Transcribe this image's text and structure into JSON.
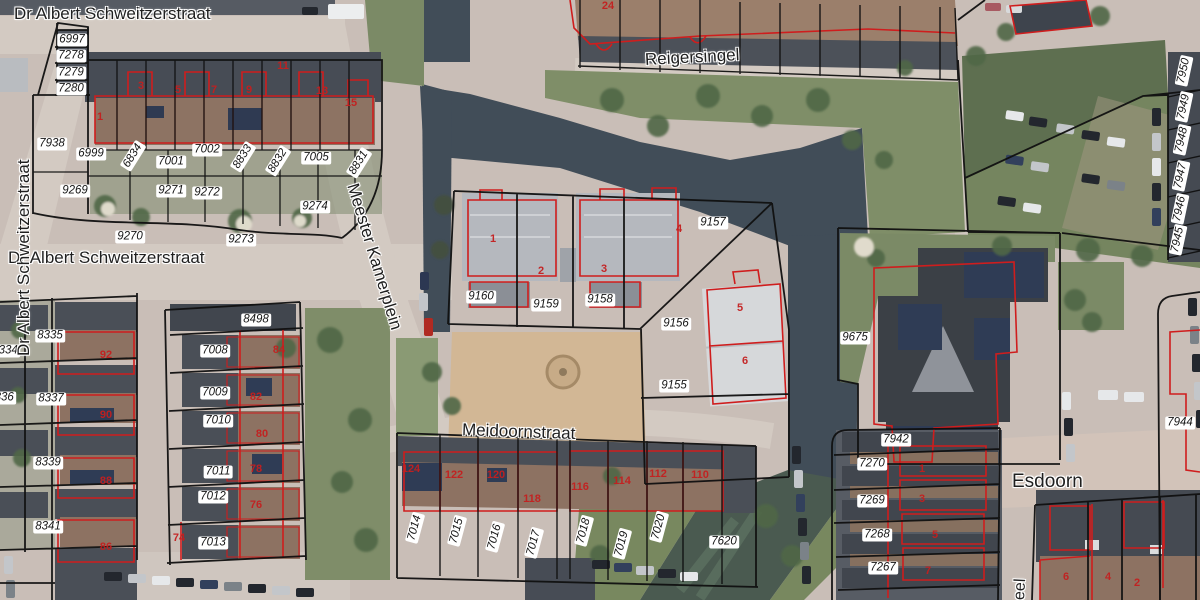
{
  "colors": {
    "parcel_line": "#101010",
    "building_outline": "#cf1d1d",
    "label_bg": "#ffffff",
    "label_text": "#141414",
    "house_number": "#c41f1f",
    "street_text": "#1f1f1f"
  },
  "streets": [
    {
      "name": "Dr Albert Schweitzerstraat",
      "x": 14,
      "y": 14,
      "rot": 0,
      "size": 17
    },
    {
      "name": "Dr Albert Schweitzerstraat",
      "x": 8,
      "y": 258,
      "rot": 0,
      "size": 17
    },
    {
      "name": "Dr Albert Schweitzerstraat",
      "x": 24,
      "y": 356,
      "rot": -90,
      "size": 17
    },
    {
      "name": "Reigersingel",
      "x": 645,
      "y": 60,
      "rot": -3,
      "size": 17
    },
    {
      "name": "Meester Kamerplein",
      "x": 352,
      "y": 184,
      "rot": 73,
      "size": 17
    },
    {
      "name": "Meidoornstraat",
      "x": 462,
      "y": 430,
      "rot": 2,
      "size": 17
    },
    {
      "name": "Esdoorn",
      "x": 1012,
      "y": 482,
      "rot": 0,
      "size": 19
    },
    {
      "name": "eel",
      "x": 1020,
      "y": 600,
      "rot": -87,
      "size": 16
    }
  ],
  "parcel_labels": [
    {
      "id": "6997",
      "x": 72,
      "y": 40
    },
    {
      "id": "7278",
      "x": 71,
      "y": 56
    },
    {
      "id": "7279",
      "x": 71,
      "y": 73
    },
    {
      "id": "7280",
      "x": 71,
      "y": 89
    },
    {
      "id": "7938",
      "x": 52,
      "y": 144
    },
    {
      "id": "6999",
      "x": 91,
      "y": 154
    },
    {
      "id": "6834",
      "x": 133,
      "y": 156,
      "rot": -58
    },
    {
      "id": "7001",
      "x": 171,
      "y": 162
    },
    {
      "id": "7002",
      "x": 207,
      "y": 150
    },
    {
      "id": "8833",
      "x": 243,
      "y": 157,
      "rot": -58
    },
    {
      "id": "8832",
      "x": 278,
      "y": 161,
      "rot": -58
    },
    {
      "id": "7005",
      "x": 316,
      "y": 158
    },
    {
      "id": "8831",
      "x": 359,
      "y": 163,
      "rot": -58
    },
    {
      "id": "9269",
      "x": 75,
      "y": 191
    },
    {
      "id": "9271",
      "x": 171,
      "y": 191
    },
    {
      "id": "9272",
      "x": 207,
      "y": 193
    },
    {
      "id": "9274",
      "x": 315,
      "y": 207
    },
    {
      "id": "9270",
      "x": 130,
      "y": 237
    },
    {
      "id": "9273",
      "x": 241,
      "y": 240
    },
    {
      "id": "8334",
      "x": 5,
      "y": 351
    },
    {
      "id": "8335",
      "x": 50,
      "y": 336
    },
    {
      "id": "8336",
      "x": 1,
      "y": 398
    },
    {
      "id": "8337",
      "x": 51,
      "y": 399
    },
    {
      "id": "8339",
      "x": 48,
      "y": 463
    },
    {
      "id": "8341",
      "x": 48,
      "y": 527
    },
    {
      "id": "8498",
      "x": 256,
      "y": 320
    },
    {
      "id": "7008",
      "x": 215,
      "y": 351
    },
    {
      "id": "7009",
      "x": 215,
      "y": 393
    },
    {
      "id": "7010",
      "x": 218,
      "y": 421
    },
    {
      "id": "7011",
      "x": 218,
      "y": 472
    },
    {
      "id": "7012",
      "x": 213,
      "y": 497
    },
    {
      "id": "7013",
      "x": 213,
      "y": 543
    },
    {
      "id": "9160",
      "x": 481,
      "y": 297
    },
    {
      "id": "9159",
      "x": 546,
      "y": 305
    },
    {
      "id": "9158",
      "x": 600,
      "y": 300
    },
    {
      "id": "9157",
      "x": 713,
      "y": 223
    },
    {
      "id": "9156",
      "x": 676,
      "y": 324
    },
    {
      "id": "9155",
      "x": 674,
      "y": 386
    },
    {
      "id": "9675",
      "x": 855,
      "y": 338
    },
    {
      "id": "7942",
      "x": 896,
      "y": 440
    },
    {
      "id": "7270",
      "x": 872,
      "y": 464
    },
    {
      "id": "7269",
      "x": 872,
      "y": 501
    },
    {
      "id": "7268",
      "x": 877,
      "y": 535
    },
    {
      "id": "7267",
      "x": 883,
      "y": 568
    },
    {
      "id": "7620",
      "x": 724,
      "y": 542
    },
    {
      "id": "7014",
      "x": 415,
      "y": 528,
      "rot": -75
    },
    {
      "id": "7015",
      "x": 457,
      "y": 531,
      "rot": -75
    },
    {
      "id": "7016",
      "x": 495,
      "y": 537,
      "rot": -75
    },
    {
      "id": "7017",
      "x": 534,
      "y": 543,
      "rot": -75
    },
    {
      "id": "7018",
      "x": 584,
      "y": 531,
      "rot": -75
    },
    {
      "id": "7019",
      "x": 622,
      "y": 544,
      "rot": -75
    },
    {
      "id": "7020",
      "x": 659,
      "y": 527,
      "rot": -75
    },
    {
      "id": "7950",
      "x": 1184,
      "y": 71,
      "rot": -78
    },
    {
      "id": "7949",
      "x": 1184,
      "y": 107,
      "rot": -78
    },
    {
      "id": "7948",
      "x": 1182,
      "y": 140,
      "rot": -78
    },
    {
      "id": "7947",
      "x": 1181,
      "y": 176,
      "rot": -78
    },
    {
      "id": "7946",
      "x": 1180,
      "y": 209,
      "rot": -78
    },
    {
      "id": "7945",
      "x": 1178,
      "y": 240,
      "rot": -78
    },
    {
      "id": "7944",
      "x": 1180,
      "y": 423
    }
  ],
  "house_numbers": [
    {
      "n": "1",
      "x": 100,
      "y": 117
    },
    {
      "n": "3",
      "x": 141,
      "y": 86
    },
    {
      "n": "5",
      "x": 178,
      "y": 90
    },
    {
      "n": "7",
      "x": 214,
      "y": 90
    },
    {
      "n": "9",
      "x": 249,
      "y": 90
    },
    {
      "n": "11",
      "x": 283,
      "y": 66
    },
    {
      "n": "13",
      "x": 322,
      "y": 91
    },
    {
      "n": "15",
      "x": 351,
      "y": 103
    },
    {
      "n": "24",
      "x": 608,
      "y": 6
    },
    {
      "n": "92",
      "x": 106,
      "y": 355
    },
    {
      "n": "90",
      "x": 106,
      "y": 415
    },
    {
      "n": "88",
      "x": 106,
      "y": 481
    },
    {
      "n": "86",
      "x": 106,
      "y": 547
    },
    {
      "n": "84",
      "x": 279,
      "y": 350
    },
    {
      "n": "82",
      "x": 256,
      "y": 397
    },
    {
      "n": "80",
      "x": 262,
      "y": 434
    },
    {
      "n": "78",
      "x": 256,
      "y": 469
    },
    {
      "n": "76",
      "x": 256,
      "y": 505
    },
    {
      "n": "74",
      "x": 179,
      "y": 538
    },
    {
      "n": "1",
      "x": 493,
      "y": 239
    },
    {
      "n": "2",
      "x": 541,
      "y": 271
    },
    {
      "n": "3",
      "x": 604,
      "y": 269
    },
    {
      "n": "4",
      "x": 679,
      "y": 229
    },
    {
      "n": "5",
      "x": 740,
      "y": 308
    },
    {
      "n": "6",
      "x": 745,
      "y": 361
    },
    {
      "n": "124",
      "x": 411,
      "y": 469
    },
    {
      "n": "122",
      "x": 454,
      "y": 475
    },
    {
      "n": "120",
      "x": 496,
      "y": 475
    },
    {
      "n": "118",
      "x": 532,
      "y": 499
    },
    {
      "n": "116",
      "x": 580,
      "y": 487
    },
    {
      "n": "114",
      "x": 622,
      "y": 481
    },
    {
      "n": "112",
      "x": 658,
      "y": 474
    },
    {
      "n": "110",
      "x": 700,
      "y": 475
    },
    {
      "n": "1",
      "x": 922,
      "y": 469
    },
    {
      "n": "3",
      "x": 922,
      "y": 499
    },
    {
      "n": "5",
      "x": 935,
      "y": 535
    },
    {
      "n": "7",
      "x": 928,
      "y": 571
    },
    {
      "n": "6",
      "x": 1066,
      "y": 577
    },
    {
      "n": "4",
      "x": 1108,
      "y": 577
    },
    {
      "n": "2",
      "x": 1137,
      "y": 583
    }
  ]
}
